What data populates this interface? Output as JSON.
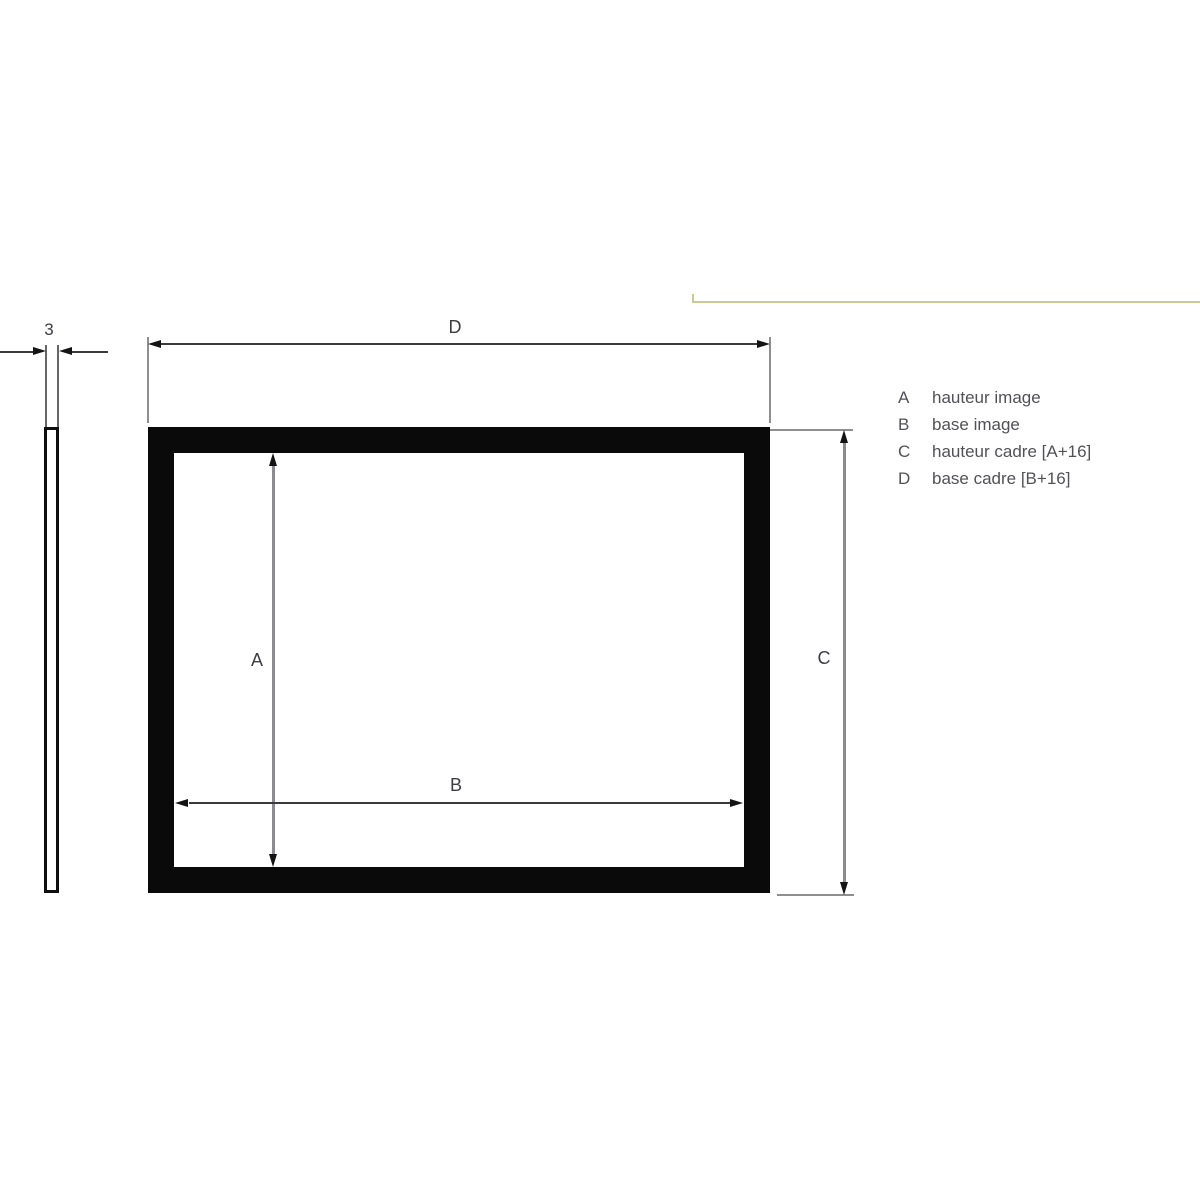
{
  "diagram": {
    "dimensions": {
      "profile_thickness": {
        "label": "3"
      },
      "top_width": {
        "label": "D"
      },
      "image_height": {
        "label": "A"
      },
      "image_base": {
        "label": "B"
      },
      "frame_height": {
        "label": "C"
      }
    },
    "legend": {
      "items": [
        {
          "key": "A",
          "label": "hauteur image"
        },
        {
          "key": "B",
          "label": "base image"
        },
        {
          "key": "C",
          "label": "hauteur cadre [A+16]"
        },
        {
          "key": "D",
          "label": "base cadre [B+16]"
        }
      ]
    },
    "colors": {
      "background": "#ffffff",
      "frame": "#0a0a0a",
      "dim_line_dark": "#3a3a3a",
      "dim_line_light": "#8c8c90",
      "extension_line": "#8f8f8f",
      "arrowhead": "#141414",
      "dim_label": "#3d3d44",
      "legend_text": "#515157",
      "accent_line": "#c9cc92",
      "profile_outline": "#0e0e0e"
    }
  }
}
